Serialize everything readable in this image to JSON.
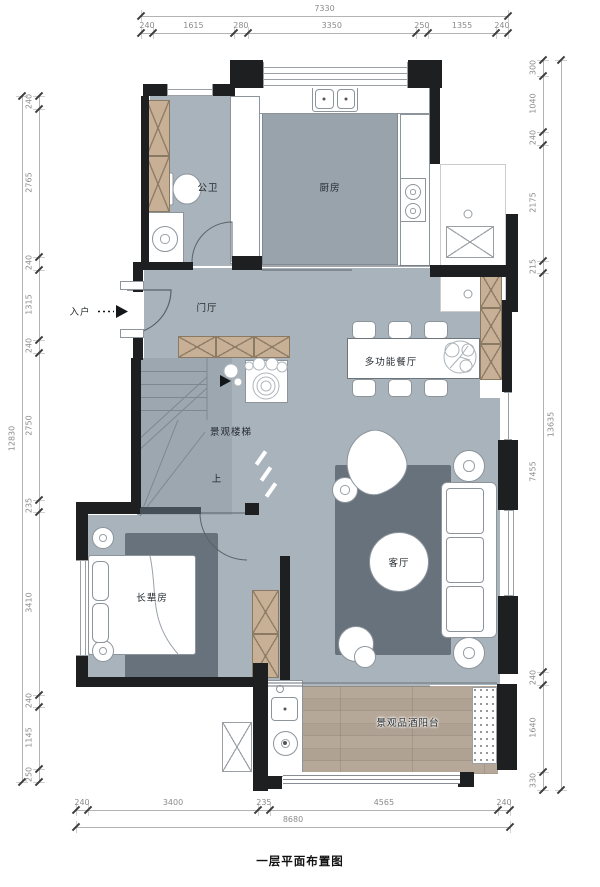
{
  "title": {
    "caption": "一层平面布置图"
  },
  "rooms": {
    "bathroom": "公卫",
    "kitchen": "厨房",
    "foyer": "门厅",
    "dining": "多功能餐厅",
    "stairs": "景观楼梯",
    "living": "客厅",
    "bedroom": "长辈房",
    "balcony": "景观品酒阳台"
  },
  "annotations": {
    "entry": "入户",
    "stairs_up": "上"
  },
  "dimensions": {
    "top": {
      "total": 7330,
      "segments": [
        240,
        1615,
        280,
        3350,
        250,
        1355,
        240
      ]
    },
    "bottom": {
      "total": 8680,
      "segments": [
        240,
        3400,
        235,
        4565,
        240
      ]
    },
    "left": {
      "total": 12830,
      "segments": [
        240,
        2765,
        240,
        1315,
        240,
        2750,
        235,
        3410,
        240,
        1145,
        250
      ]
    },
    "right": {
      "total": 13635,
      "segments": [
        300,
        1040,
        240,
        2175,
        215,
        7455,
        240,
        1640,
        330
      ]
    }
  },
  "colors": {
    "floor": "#a9b3bb",
    "island": "#98a3ac",
    "rug": "#67727c",
    "wall": "#1d1f21",
    "cabinet": "#c7b096",
    "wood": "#b0a293"
  }
}
